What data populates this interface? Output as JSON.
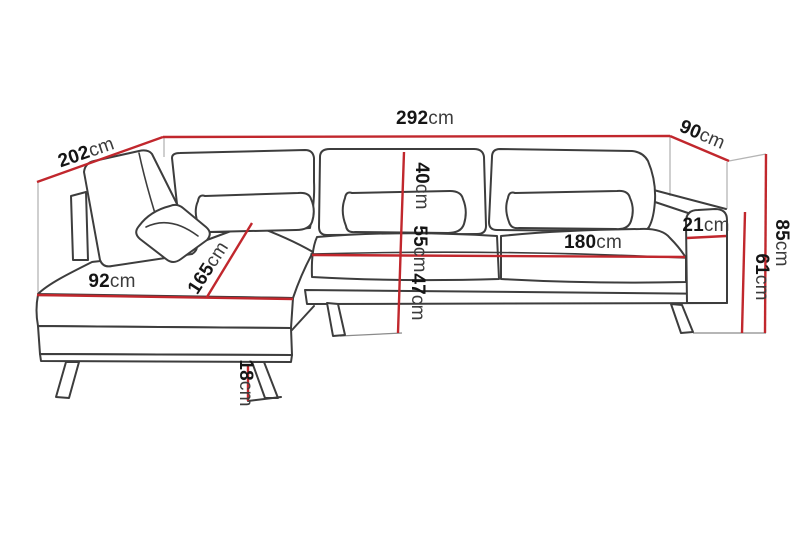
{
  "diagram": {
    "kind": "corner-sofa-dimension-diagram",
    "unit": "cm"
  },
  "colors": {
    "dimension_line": "#c1272d",
    "outline": "#3d3d3d",
    "guide": "#b5b5b5",
    "background": "#ffffff",
    "label_number": "#151515",
    "label_unit": "#3c3c3c"
  },
  "dims": {
    "total_width": {
      "value": "292",
      "unit": "cm"
    },
    "left_side_length": {
      "value": "202",
      "unit": "cm"
    },
    "right_side_depth": {
      "value": "90",
      "unit": "cm"
    },
    "total_height": {
      "value": "85",
      "unit": "cm"
    },
    "armrest_height": {
      "value": "61",
      "unit": "cm"
    },
    "armrest_top_width": {
      "value": "21",
      "unit": "cm"
    },
    "seat_width": {
      "value": "180",
      "unit": "cm"
    },
    "backrest_height": {
      "value": "40",
      "unit": "cm"
    },
    "back_seat_height": {
      "value": "55",
      "unit": "cm"
    },
    "seat_height": {
      "value": "47",
      "unit": "cm"
    },
    "chaise_front_width": {
      "value": "92",
      "unit": "cm"
    },
    "chaise_length": {
      "value": "165",
      "unit": "cm"
    },
    "leg_height": {
      "value": "18",
      "unit": "cm"
    }
  }
}
